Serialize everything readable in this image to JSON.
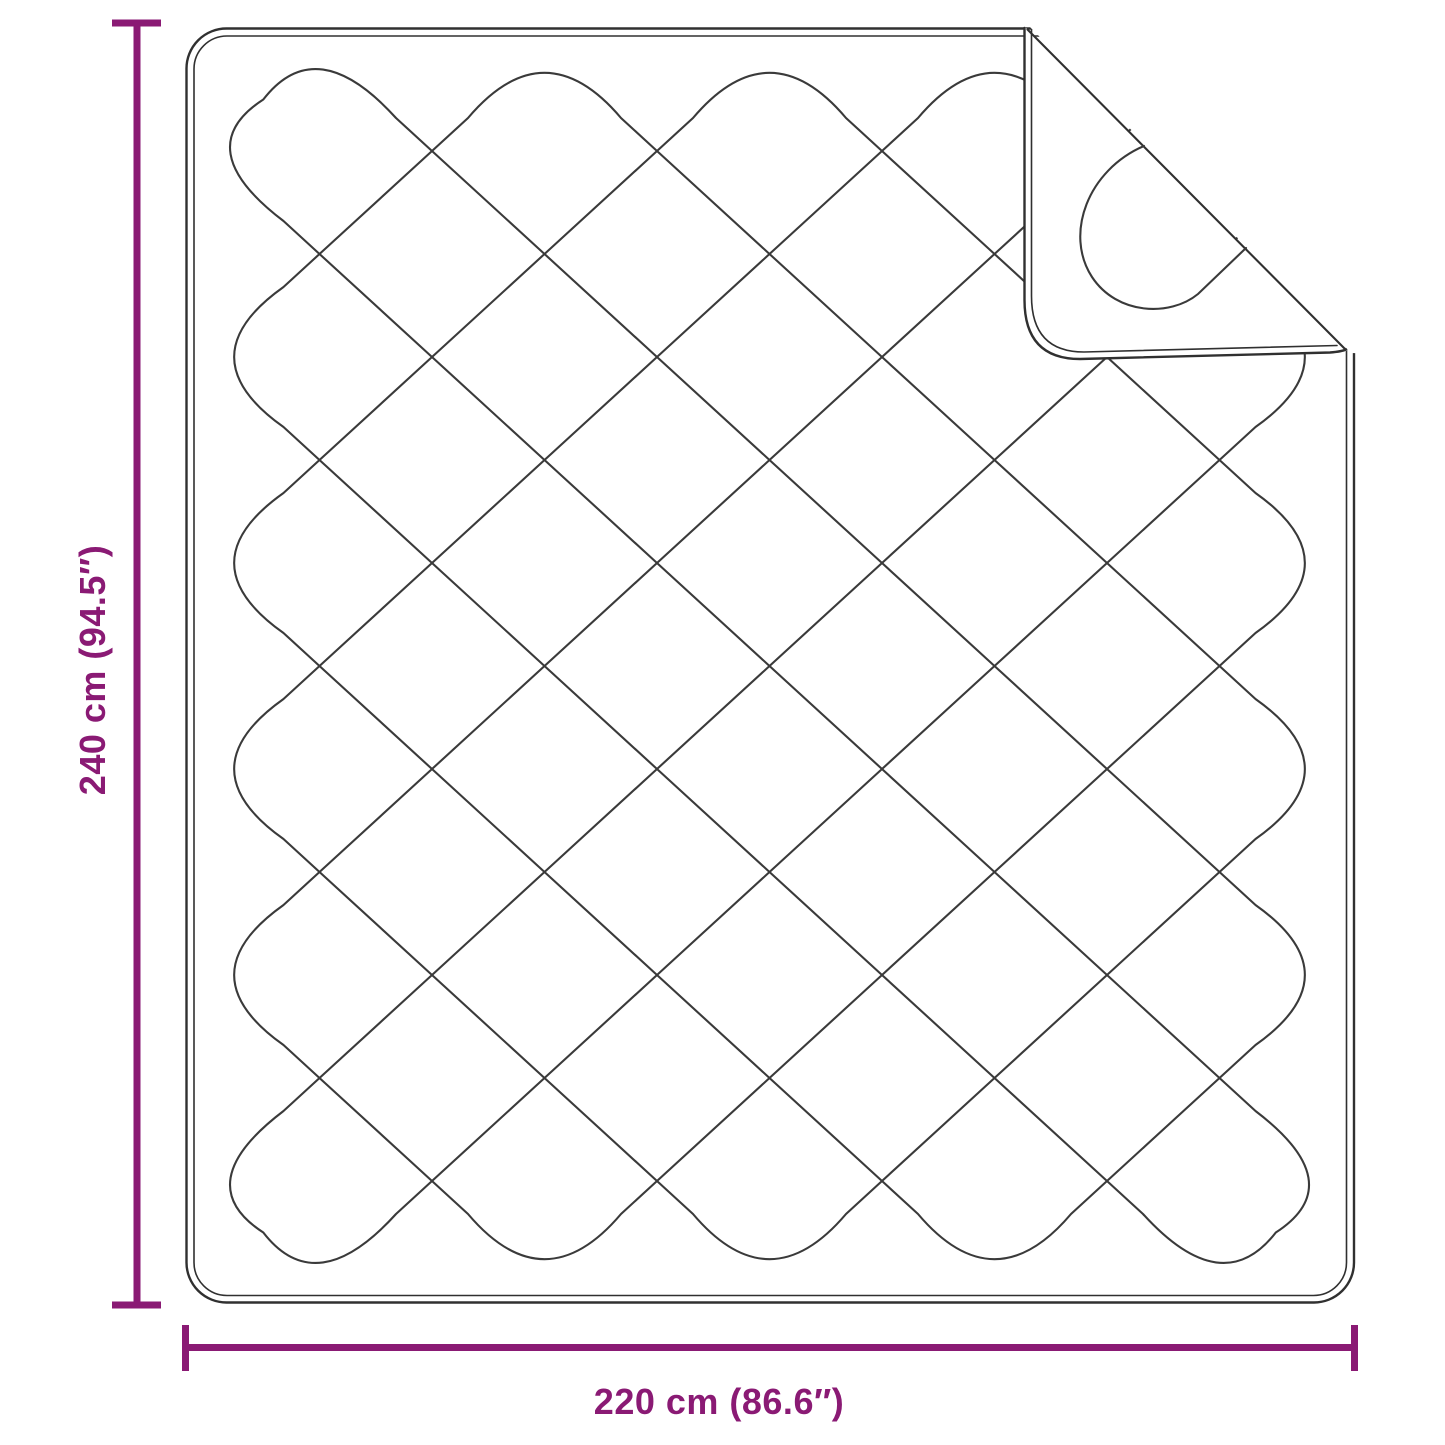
{
  "diagram": {
    "type": "product-dimension-diagram",
    "subject": "quilted blanket with folded corner",
    "vertical_dimension": {
      "label": "240 cm (94.5″)"
    },
    "horizontal_dimension": {
      "label": "220 cm (86.6″)"
    },
    "colors": {
      "dimension_accent": "#8A1A74",
      "outline_dark": "#303030",
      "quilt_line": "#3a3a3a",
      "background": "#ffffff"
    }
  }
}
